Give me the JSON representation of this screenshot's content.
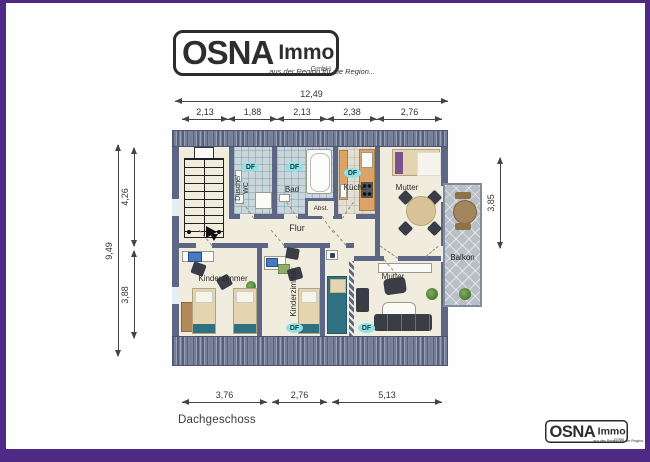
{
  "branding": {
    "name": "OSNA",
    "product": "Immo",
    "legal": "GmbH",
    "slogan": "...aus der Region für die Region..."
  },
  "plan": {
    "floor_label": "Dachgeschoss",
    "skylight": "DF",
    "rooms": {
      "shower_wc": "Dusche/\nWC",
      "bath": "Bad",
      "kitchen": "Küche",
      "storage": "Abst.",
      "hall": "Flur",
      "mother_top": "Mutter",
      "child_left": "Kinderzimmer",
      "child_mid": "Kinderzimmer",
      "mother_bottom": "Mutter",
      "balcony": "Balkon"
    }
  },
  "dimensions": {
    "top_total": "12,49",
    "top_segments": [
      "2,13",
      "1,88",
      "2,13",
      "2,38",
      "2,76"
    ],
    "left_total": "9,49",
    "left_upper": "4,26",
    "left_lower": "3,88",
    "right_balcony": "3,85",
    "bottom_segments": [
      "3,76",
      "2,76",
      "5,13"
    ]
  },
  "colors": {
    "accent_purple": "#4e2a86",
    "wall": "#5d6684",
    "tile": "#c9d6da",
    "floor": "#f1edde",
    "balcony_tile": "#b7bfc7",
    "skylight_highlight": "#8ce4ea",
    "wood": "#dca266"
  }
}
